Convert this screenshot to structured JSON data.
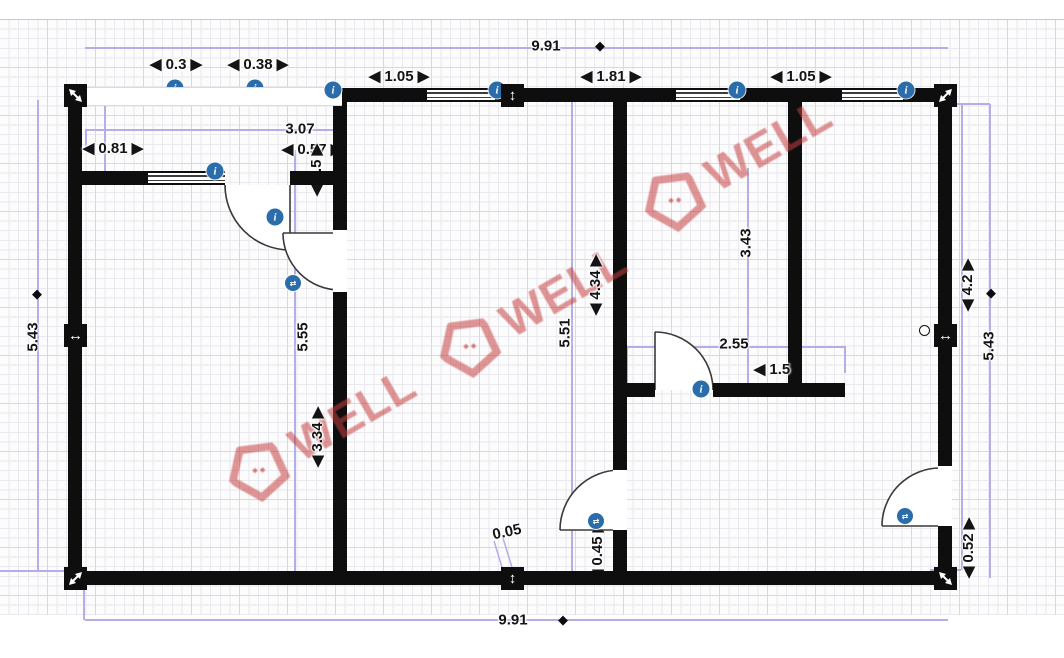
{
  "watermarks": {
    "text": "WELL"
  },
  "glyphs": {
    "info": "i",
    "door_swap": "⇄",
    "diamond": "◆",
    "v_arrow": "↕",
    "h_arrow": "↔"
  },
  "colors": {
    "wall": "#0e0e0e",
    "accent_blue": "#2b6cab",
    "dim_purple": "#b3aee6",
    "watermark_red": "#c53e3e"
  },
  "dim_labels": {
    "top_total": "9.91",
    "bottom_total": "9.91",
    "left_total": "5.43",
    "right_total": "5.43",
    "top_seg_03": "◀ 0.3 ▶",
    "top_seg_038": "◀ 0.38 ▶",
    "top_seg_105_left": "◀ 1.05 ▶",
    "top_seg_181": "◀ 1.81 ▶",
    "top_seg_105_right": "◀ 1.05 ▶",
    "room1_width": "3.07",
    "room1_seg_081": "◀ 0.81 ▶",
    "room1_seg_057": "◀ 0.57 ▶",
    "room1_seg_15": "◀ 1.5 ▶",
    "room1_height": "5.55",
    "room1_seg_334": "◀ 3.34 ▶",
    "mid_height": "5.51",
    "mid_seg_434": "◀ 4.34 ▶",
    "wall_ht_343": "3.43",
    "room2_width": "2.55",
    "room2_seg_15": "◀ 1.5",
    "seg_005": "0.05",
    "seg_045": "◀ 0.45 ▶",
    "seg_052": "◀ 0.52 ▶",
    "right_seg_42": "◀ 4.2 ▶"
  }
}
